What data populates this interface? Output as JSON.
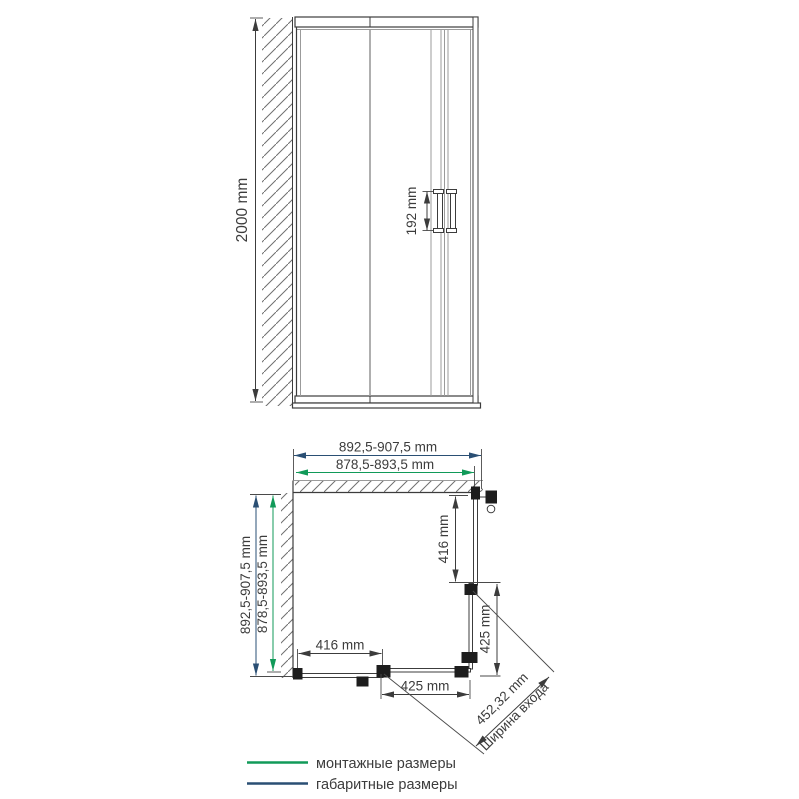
{
  "front_view": {
    "height_dimension": "2000 mm",
    "handle_dimension": "192 mm"
  },
  "plan_view": {
    "top_overall_dimension": "892,5-907,5 mm",
    "top_mounting_dimension": "878,5-893,5 mm",
    "left_overall_dimension": "892,5-907,5 mm",
    "left_mounting_dimension": "878,5-893,5 mm",
    "right_fixed_panel_dimension": "416 mm",
    "right_door_dimension": "425 mm",
    "bottom_fixed_panel_dimension": "416 mm",
    "bottom_door_dimension": "425 mm",
    "entrance_width_dimension": "452,32 mm",
    "entrance_width_label": "Ширина входа"
  },
  "legend": {
    "mounting_label": "монтажные размеры",
    "overall_label": "габаритные размеры"
  },
  "colors": {
    "mounting_green": "#119a59",
    "overall_navy": "#2a4f74",
    "ink": "#3c3c3c"
  }
}
